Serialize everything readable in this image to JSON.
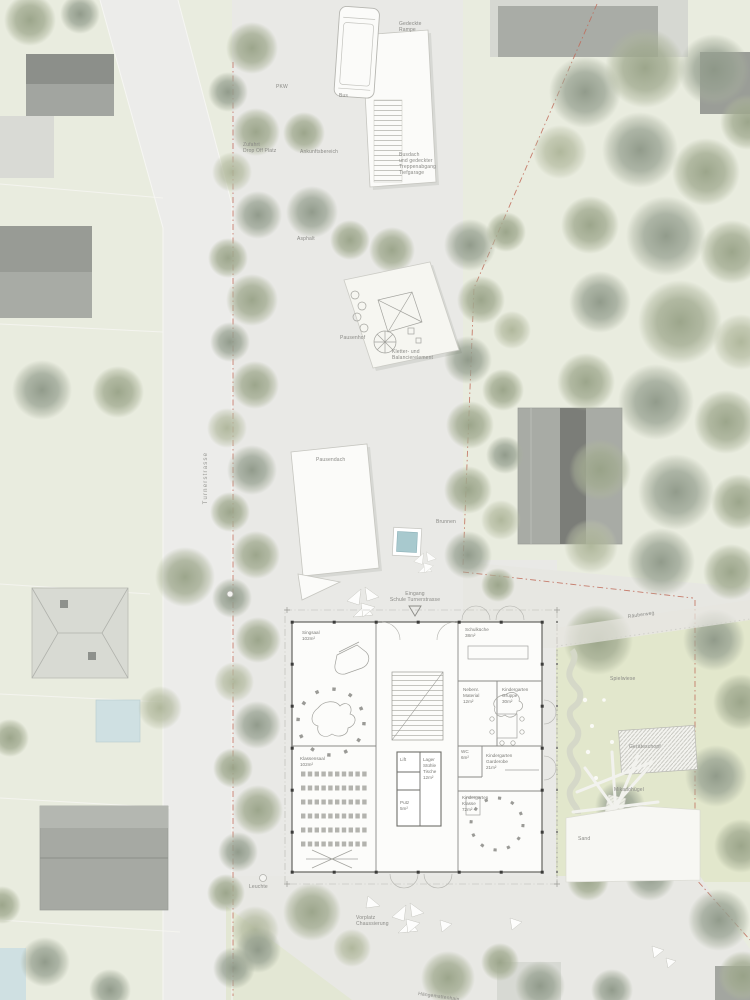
{
  "streets": {
    "turnerstrasse": "Turnerstrasse",
    "haengemattenhain": "Hängemattenhain"
  },
  "site": {
    "gedeckte_rampe": [
      "Gedeckte",
      "Rampe"
    ],
    "pkw": "PKW",
    "bus": "Bus",
    "zufahrt": [
      "Zufahrt",
      "Drop Off Platz"
    ],
    "ankunftsbereich": "Ankunftsbereich",
    "busdach": [
      "Busdach",
      "und gedeckter",
      "Treppenabgang",
      "Tiefgarage"
    ],
    "asphalt": "Asphalt",
    "pausenhof": "Pausenhof",
    "kletter": [
      "Kletter- und",
      "Balancierelement"
    ],
    "pausendach": "Pausendach",
    "brunnen": "Brunnen",
    "eingang": [
      "Eingang",
      "Schule Turnerstrasse"
    ],
    "leuchte": "Leuchte",
    "vorplatz": [
      "Vorplatz",
      "Chaussierung"
    ]
  },
  "garden": {
    "raeuberweg": "Räuberweg",
    "spielwiese": "Spielwiese",
    "geraeteschopf": "Geräteschopf",
    "mikadohuegel": "Mikadohügel",
    "sand": "Sand"
  },
  "building": {
    "singsaal": [
      "Singsaal",
      "102m²"
    ],
    "klassensaal": [
      "Klassensaal",
      "102m²"
    ],
    "schulkueche": [
      "Schulküche",
      "38m²"
    ],
    "material": [
      "Nebenr.",
      "Material",
      "12m²"
    ],
    "gruppe": [
      "Kindergarten",
      "Gruppe",
      "30m²"
    ],
    "lift": "Lift",
    "lager": [
      "Lager",
      "Stühle",
      "Tische",
      "12m²"
    ],
    "putz": [
      "Putz",
      "5m²"
    ],
    "wc": [
      "WC",
      "6m²"
    ],
    "garderobe": [
      "Kindergarten",
      "Garderobe",
      "21m²"
    ],
    "klasse": [
      "Kindergarten",
      "Klasse",
      "72m²"
    ]
  },
  "colors": {
    "paper_green": "#e9ecdf",
    "paved_gray": "#e9e9e6",
    "street_gray": "#ececea",
    "garden_green": "#e3e8cd",
    "tree_green": "#9ba58a",
    "building_gray": "#a6a9a3",
    "roof_dark": "#7b7d78",
    "white_structure": "#fbfbf9",
    "pool_blue": "#cfe0e2",
    "fountain_blue": "#a8c9ce",
    "boundary_red": "#c06a58",
    "label_gray": "#8a8a86"
  }
}
